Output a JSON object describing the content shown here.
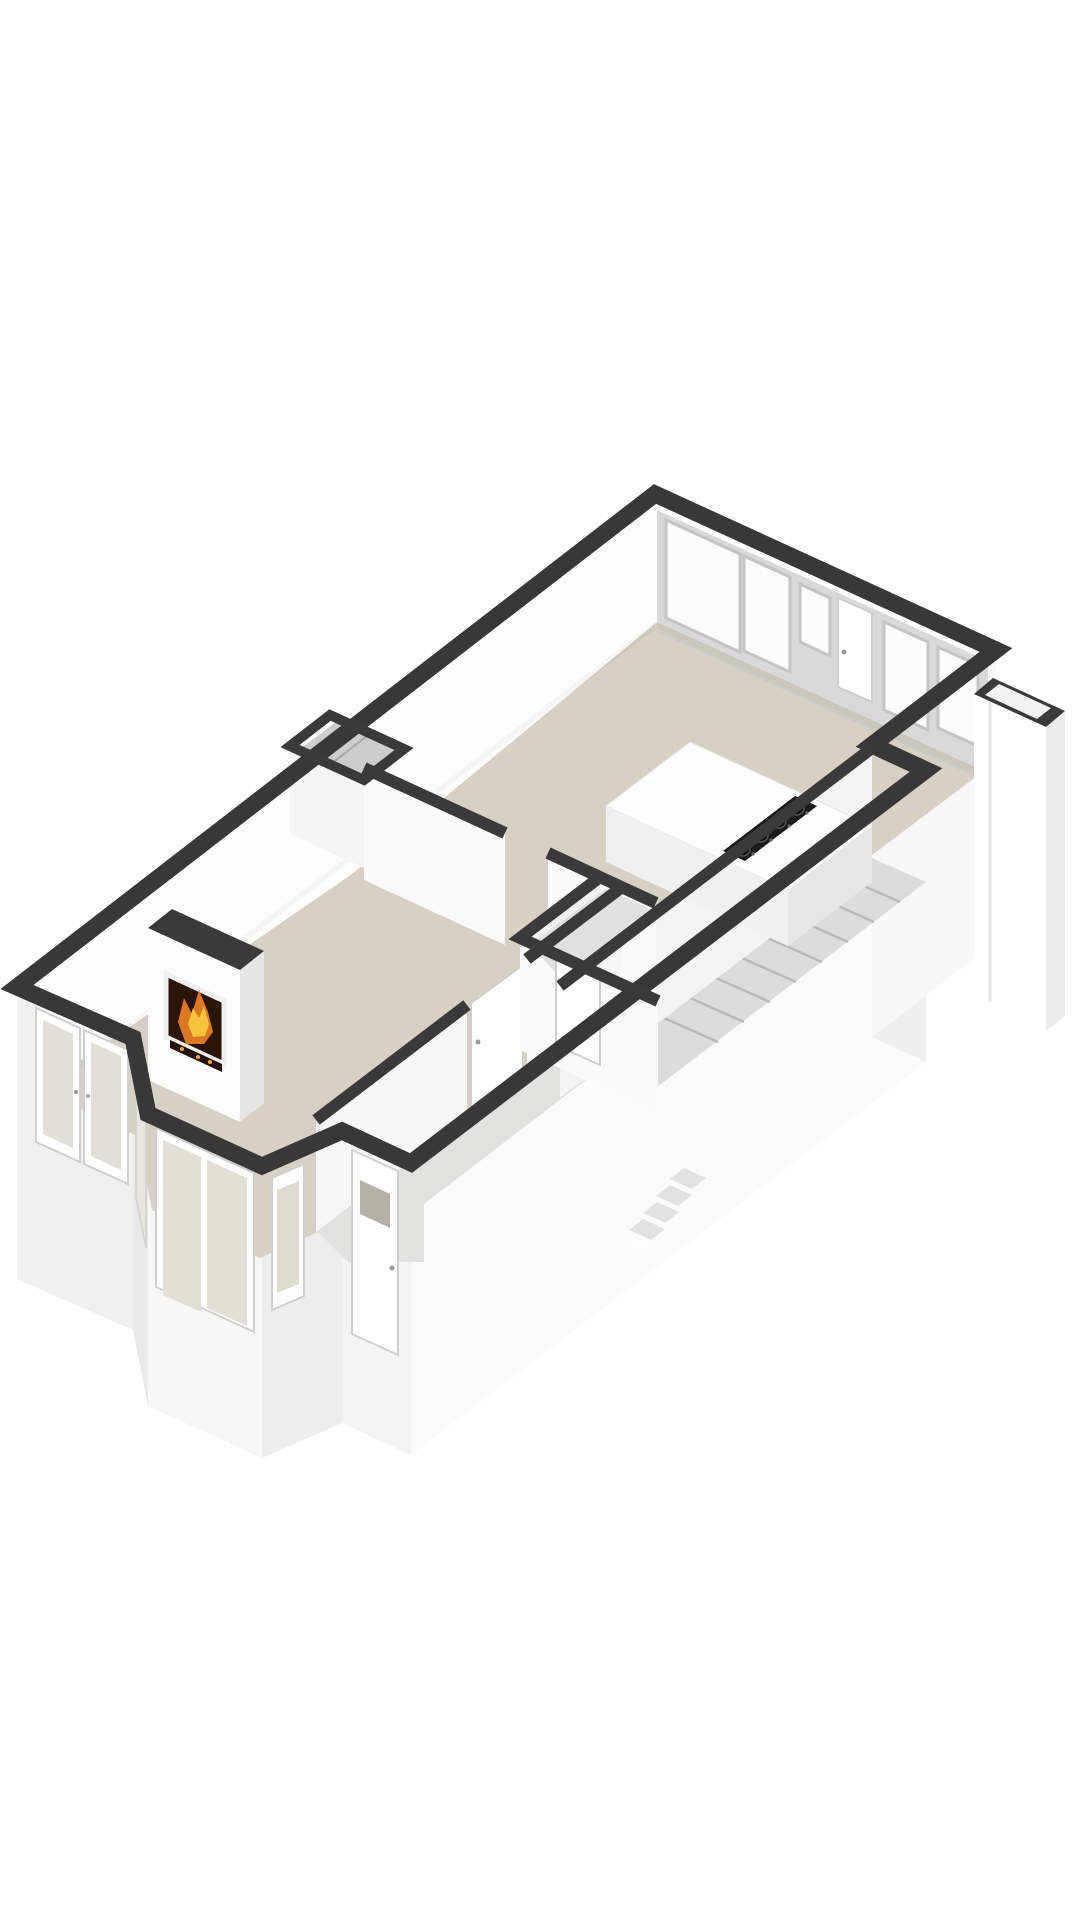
{
  "canvas": {
    "width": 1080,
    "height": 1920,
    "background": "#ffffff"
  },
  "palette": {
    "wall_cut": "#383838",
    "wall_cut_interior": "#3a3a3a",
    "floor_main": "#d7d0c3",
    "floor_hall": "#e1e1e0",
    "glass_tint": "#e3dfd4",
    "fire_orange": "#dd7722",
    "fire_yellow": "#f6c53d",
    "cooktop_black": "#1a1a1a"
  },
  "semantics": {
    "drawing_kind": "3d-floorplan-render",
    "rooms": [
      {
        "id": "living-room",
        "floor": "beige",
        "features": [
          "fireplace",
          "bay-window",
          "french-door",
          "meter-closet"
        ]
      },
      {
        "id": "kitchen-dining",
        "floor": "beige",
        "features": [
          "window-wall",
          "exterior-door",
          "counter-with-cooktop-4-burners"
        ]
      },
      {
        "id": "hallway",
        "floor": "light-gray",
        "features": [
          "interior-doors",
          "front-door"
        ]
      },
      {
        "id": "stair-hall",
        "floor": "light-gray",
        "features": [
          "staircase-8-treads",
          "exterior-steps-4"
        ]
      },
      {
        "id": "storage-annex",
        "floor": "open-top",
        "features": [
          "attached-at-east-corner"
        ]
      }
    ]
  },
  "shapes": [
    {
      "name": "sw-wall-exterior-face",
      "type": "polygon",
      "points": "17,987 133,1038 133,1330 17,1279",
      "fill": "#f0f0f0"
    },
    {
      "name": "bay-left-exterior-face",
      "type": "polygon",
      "points": "133,1038 148,1114 148,1406 133,1330",
      "fill": "#e9e9e9"
    },
    {
      "name": "bay-front-exterior-face",
      "type": "polygon",
      "points": "148,1114 262,1166 262,1458 148,1406",
      "fill": "#f7f7f7"
    },
    {
      "name": "bay-right-exterior-face",
      "type": "polygon",
      "points": "262,1166 342,1131 342,1423 262,1458",
      "fill": "#ededed"
    },
    {
      "name": "entry-wall-exterior-face",
      "type": "polygon",
      "points": "342,1131 411,1163 411,1455 342,1423",
      "fill": "#f4f4f4"
    },
    {
      "name": "se-wall-exterior-face",
      "type": "polygon",
      "points": "411,1163 926,770 926,1062 411,1455",
      "fill": "#fbfbfb"
    },
    {
      "name": "se-jut-exterior-face",
      "type": "polygon",
      "points": "872,745 926,770 926,1062 872,1037",
      "fill": "#efefef"
    },
    {
      "name": "east-wall-exterior-face",
      "type": "polygon",
      "points": "996,650 872,745 872,1037 996,942",
      "fill": "#f8f8f8"
    },
    {
      "name": "kitchen-floor",
      "type": "polygon",
      "points": "657,622 985,770 868,858 920,882 660,1080 352,874",
      "fill": "#d7d0c3"
    },
    {
      "name": "living-room-floor",
      "type": "polygon",
      "points": "352,874 622,999 318,1232 260,1258 152,1210 137,1136 40,1089",
      "fill": "#d7d0c3"
    },
    {
      "name": "hallway-floor",
      "type": "polygon",
      "points": "630,999 668,1017 424,1204 424,1262 348,1262 316,1230",
      "fill": "#e1e1e0"
    },
    {
      "name": "stairwell-floor",
      "type": "polygon",
      "points": "872,858 926,882 640,1100 586,1076",
      "fill": "#dcdcdc"
    },
    {
      "name": "nw-wall-inner-face",
      "type": "polygon",
      "points": "655,510 40,979 40,1091 655,622",
      "fill": "#fdfdfd"
    },
    {
      "name": "ne-window-wall-inner-face",
      "type": "polygon",
      "points": "657,510 988,661 988,773 657,622",
      "fill": "#d9d9d9"
    },
    {
      "name": "ne-wall-base-shadow",
      "type": "polygon",
      "points": "657,622 988,773 988,780 657,629",
      "fill": "rgba(0,0,0,0.05)"
    },
    {
      "name": "nw-wall-base-shadow",
      "type": "polygon",
      "points": "40,1091 655,622 655,629 40,1098",
      "fill": "rgba(0,0,0,0.04)"
    },
    {
      "name": "ne-window-pane-1",
      "type": "polygon",
      "points": "666,520 740,554 740,652 666,618",
      "fill": "#fbfbfb",
      "stroke": "#c4c4c4",
      "sw": 3
    },
    {
      "name": "ne-window-pane-2",
      "type": "polygon",
      "points": "744,556 790,577 790,672 744,651",
      "fill": "#fbfbfb",
      "stroke": "#c4c4c4",
      "sw": 3
    },
    {
      "name": "ne-window-pane-3",
      "type": "polygon",
      "points": "800,584 830,598 830,656 800,642",
      "fill": "#fbfbfb",
      "stroke": "#c4c4c4",
      "sw": 3
    },
    {
      "name": "ne-window-pane-4",
      "type": "polygon",
      "points": "884,622 928,642 928,730 884,710",
      "fill": "#fbfbfb",
      "stroke": "#c4c4c4",
      "sw": 3
    },
    {
      "name": "ne-window-pane-5",
      "type": "polygon",
      "points": "938,647 978,665 978,746 938,728",
      "fill": "#fbfbfb",
      "stroke": "#c4c4c4",
      "sw": 3
    },
    {
      "name": "ne-window-sill-line",
      "type": "line",
      "x1": 660,
      "y1": 632,
      "x2": 985,
      "y2": 780,
      "stroke": "#c9c9c9",
      "sw": 2
    },
    {
      "name": "kitchen-exterior-door",
      "type": "polygon",
      "points": "838,598 872,613 872,702 838,687",
      "fill": "#ffffff",
      "stroke": "#cdcdcd",
      "sw": 2
    },
    {
      "name": "kitchen-exterior-door-handle",
      "type": "circle",
      "cx": 844,
      "cy": 652,
      "r": 2.5,
      "fill": "#9a9a9a"
    },
    {
      "name": "stair-tread-1",
      "type": "line",
      "x1": 846,
      "y1": 878,
      "x2": 900,
      "y2": 902,
      "stroke": "#b9b9b9",
      "sw": 2.5
    },
    {
      "name": "stair-tread-2",
      "type": "line",
      "x1": 820,
      "y1": 898,
      "x2": 874,
      "y2": 922,
      "stroke": "#b9b9b9",
      "sw": 2.5
    },
    {
      "name": "stair-tread-3",
      "type": "line",
      "x1": 794,
      "y1": 918,
      "x2": 848,
      "y2": 942,
      "stroke": "#b9b9b9",
      "sw": 2.5
    },
    {
      "name": "stair-tread-4",
      "type": "line",
      "x1": 768,
      "y1": 938,
      "x2": 822,
      "y2": 962,
      "stroke": "#b9b9b9",
      "sw": 2.5
    },
    {
      "name": "stair-tread-5",
      "type": "line",
      "x1": 742,
      "y1": 958,
      "x2": 796,
      "y2": 982,
      "stroke": "#b9b9b9",
      "sw": 2.5
    },
    {
      "name": "stair-tread-6",
      "type": "line",
      "x1": 716,
      "y1": 978,
      "x2": 770,
      "y2": 1002,
      "stroke": "#b9b9b9",
      "sw": 2.5
    },
    {
      "name": "stair-tread-7",
      "type": "line",
      "x1": 690,
      "y1": 998,
      "x2": 744,
      "y2": 1022,
      "stroke": "#b9b9b9",
      "sw": 2.5
    },
    {
      "name": "stair-tread-8",
      "type": "line",
      "x1": 664,
      "y1": 1018,
      "x2": 718,
      "y2": 1042,
      "stroke": "#b9b9b9",
      "sw": 2.5
    },
    {
      "name": "stair-hall-wall-face",
      "type": "polygon",
      "points": "872,748 560,986 560,1098 872,860",
      "fill": "#f3f3f3"
    },
    {
      "name": "living-kitchen-wall-face-a",
      "type": "polygon",
      "points": "364,768 505,833 505,945 364,880",
      "fill": "#fafafa"
    },
    {
      "name": "living-kitchen-wall-face-b",
      "type": "polygon",
      "points": "548,853 656,903 656,1015 548,965",
      "fill": "#fafafa"
    },
    {
      "name": "living-hall-wall-face-a",
      "type": "polygon",
      "points": "622,887 527,959 527,1071 622,999",
      "fill": "#f7f7f7"
    },
    {
      "name": "living-hall-wall-face-b",
      "type": "polygon",
      "points": "467,1005 316,1120 316,1232 467,1117",
      "fill": "#f7f7f7"
    },
    {
      "name": "hall-door",
      "type": "polygon",
      "points": "523,965 471,1003 471,1113 523,1075",
      "fill": "#ffffff",
      "stroke": "#cdcdcd",
      "sw": 2
    },
    {
      "name": "hall-door-handle",
      "type": "circle",
      "cx": 478,
      "cy": 1042,
      "r": 2.5,
      "fill": "#9a9a9a"
    },
    {
      "name": "bathroom-wall-face-a",
      "type": "polygon",
      "points": "600,877 520,938 520,1050 600,989",
      "fill": "#f1f1f1"
    },
    {
      "name": "bathroom-wall-face-b",
      "type": "polygon",
      "points": "520,938 658,1001 658,1113 520,1050",
      "fill": "#fafafa"
    },
    {
      "name": "bathroom-floor",
      "type": "polygon",
      "points": "606,889 650,909 560,978 530,944",
      "fill": "#e0e0e0"
    },
    {
      "name": "bathroom-door",
      "type": "polygon",
      "points": "556,955 600,975 600,1065 556,1045",
      "fill": "#ffffff",
      "stroke": "#cdcdcd",
      "sw": 2
    },
    {
      "name": "bathroom-door-handle",
      "type": "circle",
      "cx": 594,
      "cy": 1018,
      "r": 2.5,
      "fill": "#9a9a9a"
    },
    {
      "name": "meter-closet-floor",
      "type": "polygon",
      "points": "336,722 398,751 362,778 300,749",
      "fill": "#cdcdcd"
    },
    {
      "name": "meter-closet-divider",
      "type": "line",
      "x1": 367,
      "y1": 736,
      "x2": 331,
      "y2": 764,
      "stroke": "#a8a8a8",
      "sw": 2
    },
    {
      "name": "meter-closet-face",
      "type": "polygon",
      "points": "290,746 364,780 364,868 290,834",
      "fill": "#f5f5f5"
    },
    {
      "name": "fireplace-chimney-front",
      "type": "polygon",
      "points": "148,928 240,970 240,1122 148,1080",
      "fill": "#fcfcfc"
    },
    {
      "name": "fireplace-chimney-side",
      "type": "polygon",
      "points": "240,970 264,951 264,1103 240,1122",
      "fill": "#e6e6e6"
    },
    {
      "name": "fireplace-chimney-top",
      "type": "polygon",
      "points": "148,928 172,909 264,951 240,970",
      "fill": "#3a3a3a"
    },
    {
      "name": "fireplace-opening",
      "type": "polygon",
      "points": "166,974 224,1001 224,1064 166,1037",
      "fill": "#2b1507"
    },
    {
      "name": "fireplace-surround-frame",
      "type": "polygon",
      "points": "166,974 224,1001 224,1064 166,1037",
      "fill": "none",
      "stroke": "#efefef",
      "sw": 5
    },
    {
      "name": "fireplace-flame-outer",
      "type": "polygon",
      "points": "178,1022 184,998 192,1014 199,990 208,1012 213,1032 204,1044 186,1044",
      "fill": "#dd7722"
    },
    {
      "name": "fireplace-flame-inner",
      "type": "polygon",
      "points": "188,1024 193,1008 199,1018 204,1006 209,1024 205,1036 193,1037",
      "fill": "#f6c53d"
    },
    {
      "name": "fireplace-logs",
      "type": "polygon",
      "points": "170,1040 222,1064 222,1072 170,1048",
      "fill": "#241107"
    },
    {
      "name": "fireplace-ember-1",
      "type": "circle",
      "cx": 182,
      "cy": 1049,
      "r": 2,
      "fill": "#f2a43a"
    },
    {
      "name": "fireplace-ember-2",
      "type": "circle",
      "cx": 198,
      "cy": 1057,
      "r": 2,
      "fill": "#f2a43a"
    },
    {
      "name": "fireplace-ember-3",
      "type": "circle",
      "cx": 210,
      "cy": 1062,
      "r": 2,
      "fill": "#f2a43a"
    },
    {
      "name": "kitchen-counter-top",
      "type": "polygon",
      "points": "690,742 872,826 788,890 606,806",
      "fill": "#fefefe",
      "stroke": "#e8e8e8",
      "sw": 1
    },
    {
      "name": "kitchen-counter-front-face",
      "type": "polygon",
      "points": "606,806 788,890 788,946 606,862",
      "fill": "#f0f0f0"
    },
    {
      "name": "kitchen-counter-side-face",
      "type": "polygon",
      "points": "788,890 872,826 872,882 788,946",
      "fill": "#e7e7e7"
    },
    {
      "name": "cooktop",
      "type": "polygon",
      "points": "817,806 745,861 723,851 795,796",
      "fill": "#1a1a1a"
    },
    {
      "name": "cooktop-burner-1",
      "type": "circle",
      "cx": 797,
      "cy": 808,
      "r": 7,
      "fill": "#0d0d0d",
      "stroke": "#555555",
      "sw": 1.5
    },
    {
      "name": "cooktop-burner-2",
      "type": "circle",
      "cx": 779,
      "cy": 821,
      "r": 7,
      "fill": "#0d0d0d",
      "stroke": "#555555",
      "sw": 1.5
    },
    {
      "name": "cooktop-burner-3",
      "type": "circle",
      "cx": 761,
      "cy": 835,
      "r": 7,
      "fill": "#0d0d0d",
      "stroke": "#555555",
      "sw": 1.5
    },
    {
      "name": "cooktop-burner-4",
      "type": "circle",
      "cx": 743,
      "cy": 849,
      "r": 7,
      "fill": "#0d0d0d",
      "stroke": "#555555",
      "sw": 1.5
    },
    {
      "name": "cooktop-burner-cap-1",
      "type": "circle",
      "cx": 797,
      "cy": 808,
      "r": 2.2,
      "fill": "#3c3c3c"
    },
    {
      "name": "cooktop-burner-cap-2",
      "type": "circle",
      "cx": 779,
      "cy": 821,
      "r": 2.2,
      "fill": "#3c3c3c"
    },
    {
      "name": "cooktop-burner-cap-3",
      "type": "circle",
      "cx": 761,
      "cy": 835,
      "r": 2.2,
      "fill": "#3c3c3c"
    },
    {
      "name": "cooktop-burner-cap-4",
      "type": "circle",
      "cx": 743,
      "cy": 849,
      "r": 2.2,
      "fill": "#3c3c3c"
    },
    {
      "name": "cooktop-knob-1",
      "type": "circle",
      "cx": 807,
      "cy": 813,
      "r": 1.6,
      "fill": "#6a6a6a"
    },
    {
      "name": "cooktop-knob-2",
      "type": "circle",
      "cx": 789,
      "cy": 826,
      "r": 1.6,
      "fill": "#6a6a6a"
    },
    {
      "name": "cooktop-knob-3",
      "type": "circle",
      "cx": 771,
      "cy": 840,
      "r": 1.6,
      "fill": "#6a6a6a"
    },
    {
      "name": "cooktop-knob-4",
      "type": "circle",
      "cx": 753,
      "cy": 854,
      "r": 1.6,
      "fill": "#6a6a6a"
    },
    {
      "name": "french-door-left-leaf",
      "type": "polygon",
      "points": "36,1008 80,1028 80,1162 36,1142",
      "fill": "#ffffff",
      "stroke": "#cfcfcf",
      "sw": 2
    },
    {
      "name": "french-door-left-glass",
      "type": "polygon",
      "points": "43,1020 73,1034 73,1148 43,1134",
      "fill": "#e2dfd6"
    },
    {
      "name": "french-door-right-leaf",
      "type": "polygon",
      "points": "84,1030 128,1050 128,1184 84,1164",
      "fill": "#ffffff",
      "stroke": "#cfcfcf",
      "sw": 2
    },
    {
      "name": "french-door-right-glass",
      "type": "polygon",
      "points": "91,1042 121,1056 121,1170 91,1156",
      "fill": "#e2dfd6"
    },
    {
      "name": "french-door-handle-left",
      "type": "circle",
      "cx": 76,
      "cy": 1092,
      "r": 2,
      "fill": "#9a9a9a"
    },
    {
      "name": "french-door-handle-right",
      "type": "circle",
      "cx": 88,
      "cy": 1096,
      "r": 2,
      "fill": "#9a9a9a"
    },
    {
      "name": "bay-front-window-frame",
      "type": "polygon",
      "points": "156,1128 254,1173 254,1332 156,1287",
      "fill": "#fdfdfd",
      "stroke": "#cfcfcf",
      "sw": 2
    },
    {
      "name": "bay-front-window-pane-1",
      "type": "polygon",
      "points": "163,1140 201,1157 201,1312 163,1295",
      "fill": "#e3dfd4"
    },
    {
      "name": "bay-front-window-pane-2",
      "type": "polygon",
      "points": "207,1160 247,1178 247,1326 207,1308",
      "fill": "#e3dfd4"
    },
    {
      "name": "bay-left-window",
      "type": "polygon",
      "points": "136,1058 146,1108 146,1248 136,1198",
      "fill": "#e9e6dd",
      "stroke": "#cfcfcf",
      "sw": 1.5
    },
    {
      "name": "bay-right-window-frame",
      "type": "polygon",
      "points": "272,1178 304,1164 304,1296 272,1310",
      "fill": "#fdfdfd",
      "stroke": "#cfcfcf",
      "sw": 2
    },
    {
      "name": "bay-right-window-pane",
      "type": "polygon",
      "points": "277,1190 299,1181 299,1284 277,1293",
      "fill": "#dfdbd0"
    },
    {
      "name": "front-door",
      "type": "polygon",
      "points": "352,1150 398,1171 398,1355 352,1334",
      "fill": "#ffffff",
      "stroke": "#cfcfcf",
      "sw": 2
    },
    {
      "name": "front-door-window",
      "type": "polygon",
      "points": "360,1180 390,1194 390,1228 360,1214",
      "fill": "#b5b1a6"
    },
    {
      "name": "front-door-handle",
      "type": "circle",
      "cx": 392,
      "cy": 1268,
      "r": 2.5,
      "fill": "#9a9a9a"
    },
    {
      "name": "exterior-step-1-top",
      "type": "polygon",
      "points": "684,1168 706,1178 692,1189 670,1179",
      "fill": "#e2e2e2"
    },
    {
      "name": "exterior-step-1-riser",
      "type": "polygon",
      "points": "670,1179 692,1189 692,1206 670,1196",
      "fill": "#fcfcfc"
    },
    {
      "name": "exterior-step-2-top",
      "type": "polygon",
      "points": "670,1185 692,1195 678,1206 656,1196",
      "fill": "#e2e2e2"
    },
    {
      "name": "exterior-step-2-riser",
      "type": "polygon",
      "points": "656,1196 678,1206 678,1223 656,1213",
      "fill": "#fcfcfc"
    },
    {
      "name": "exterior-step-3-top",
      "type": "polygon",
      "points": "657,1202 679,1212 665,1223 643,1213",
      "fill": "#e2e2e2"
    },
    {
      "name": "exterior-step-3-riser",
      "type": "polygon",
      "points": "643,1213 665,1223 665,1240 643,1230",
      "fill": "#fcfcfc"
    },
    {
      "name": "exterior-step-4-top",
      "type": "polygon",
      "points": "643,1219 665,1229 651,1240 629,1230",
      "fill": "#e2e2e2"
    },
    {
      "name": "exterior-step-4-riser",
      "type": "polygon",
      "points": "629,1230 651,1240 651,1257 629,1247",
      "fill": "#fcfcfc"
    },
    {
      "name": "annex-front-face",
      "type": "polygon",
      "points": "974,694 1046,727 1046,1031 974,998",
      "fill": "#ffffff"
    },
    {
      "name": "annex-right-face",
      "type": "polygon",
      "points": "1046,727 1065,712 1065,1016 1046,1031",
      "fill": "#ececec"
    },
    {
      "name": "annex-seam-line",
      "type": "line",
      "x1": 990,
      "y1": 702,
      "x2": 990,
      "y2": 1002,
      "stroke": "#e5e5e5",
      "sw": 3
    },
    {
      "name": "annex-wall-rim",
      "type": "polygon",
      "points": "993,678 1065,711 1046,727 974,694",
      "fill": "#3a3a3a"
    },
    {
      "name": "annex-inner-opening",
      "type": "polygon",
      "points": "999,684 1051,708 1037,719 985,695",
      "fill": "#f2f2f2"
    },
    {
      "name": "exterior-wall-cut-band",
      "type": "path",
      "d": "M655,494 L996,650 L872,745 L926,770 L411,1163 L342,1131 L262,1166 L148,1114 L133,1038 L17,987 Z",
      "fill": "none",
      "stroke": "#383838",
      "sw": 17
    },
    {
      "name": "interior-wall-band-living-kitchen",
      "type": "path",
      "d": "M364,768 L505,833 M548,853 L656,903",
      "fill": "none",
      "stroke": "#3a3a3a",
      "sw": 12
    },
    {
      "name": "interior-wall-band-living-hall",
      "type": "path",
      "d": "M622,887 L527,959 M467,1005 L316,1120",
      "fill": "none",
      "stroke": "#3a3a3a",
      "sw": 12
    },
    {
      "name": "interior-wall-band-stair-hall",
      "type": "path",
      "d": "M872,748 L560,986",
      "fill": "none",
      "stroke": "#3a3a3a",
      "sw": 12
    },
    {
      "name": "interior-wall-band-bathroom",
      "type": "path",
      "d": "M600,877 L520,938 L658,1001",
      "fill": "none",
      "stroke": "#3a3a3a",
      "sw": 12
    },
    {
      "name": "interior-wall-band-meter-closet",
      "type": "path",
      "d": "M330,715 L404,749 L364,780 L290,746 Z",
      "fill": "none",
      "stroke": "#3a3a3a",
      "sw": 10
    }
  ]
}
